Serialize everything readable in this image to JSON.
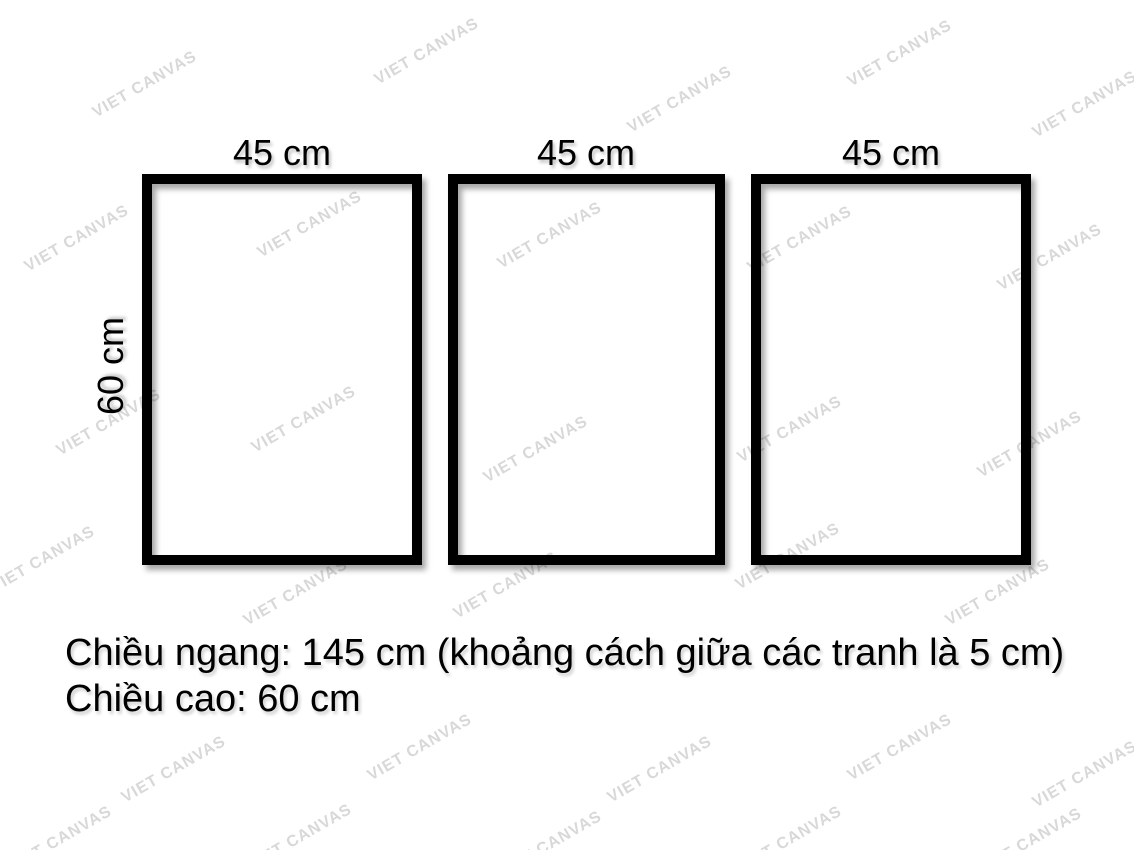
{
  "frames": [
    {
      "width_label": "45 cm"
    },
    {
      "width_label": "45 cm"
    },
    {
      "width_label": "45 cm"
    }
  ],
  "height_label": "60 cm",
  "caption": {
    "line1": "Chiều ngang: 145 cm (khoảng cách giữa các tranh là 5 cm)",
    "line2": "Chiều cao: 60 cm"
  },
  "watermark": {
    "text": "VIET CANVAS",
    "color": "#d8d8d8",
    "angle_deg": -30,
    "positions": [
      [
        145,
        85
      ],
      [
        427,
        52
      ],
      [
        680,
        100
      ],
      [
        900,
        54
      ],
      [
        1085,
        105
      ],
      [
        77,
        239
      ],
      [
        310,
        225
      ],
      [
        550,
        236
      ],
      [
        800,
        240
      ],
      [
        1050,
        258
      ],
      [
        109,
        423
      ],
      [
        304,
        420
      ],
      [
        536,
        450
      ],
      [
        790,
        430
      ],
      [
        1030,
        445
      ],
      [
        43,
        560
      ],
      [
        296,
        593
      ],
      [
        506,
        586
      ],
      [
        788,
        557
      ],
      [
        998,
        593
      ],
      [
        174,
        770
      ],
      [
        420,
        748
      ],
      [
        660,
        770
      ],
      [
        900,
        748
      ],
      [
        1085,
        775
      ],
      [
        60,
        840
      ],
      [
        300,
        838
      ],
      [
        550,
        845
      ],
      [
        790,
        840
      ],
      [
        1030,
        842
      ]
    ]
  },
  "colors": {
    "frame_border": "#000000",
    "text": "#000000",
    "watermark": "#d8d8d8"
  }
}
